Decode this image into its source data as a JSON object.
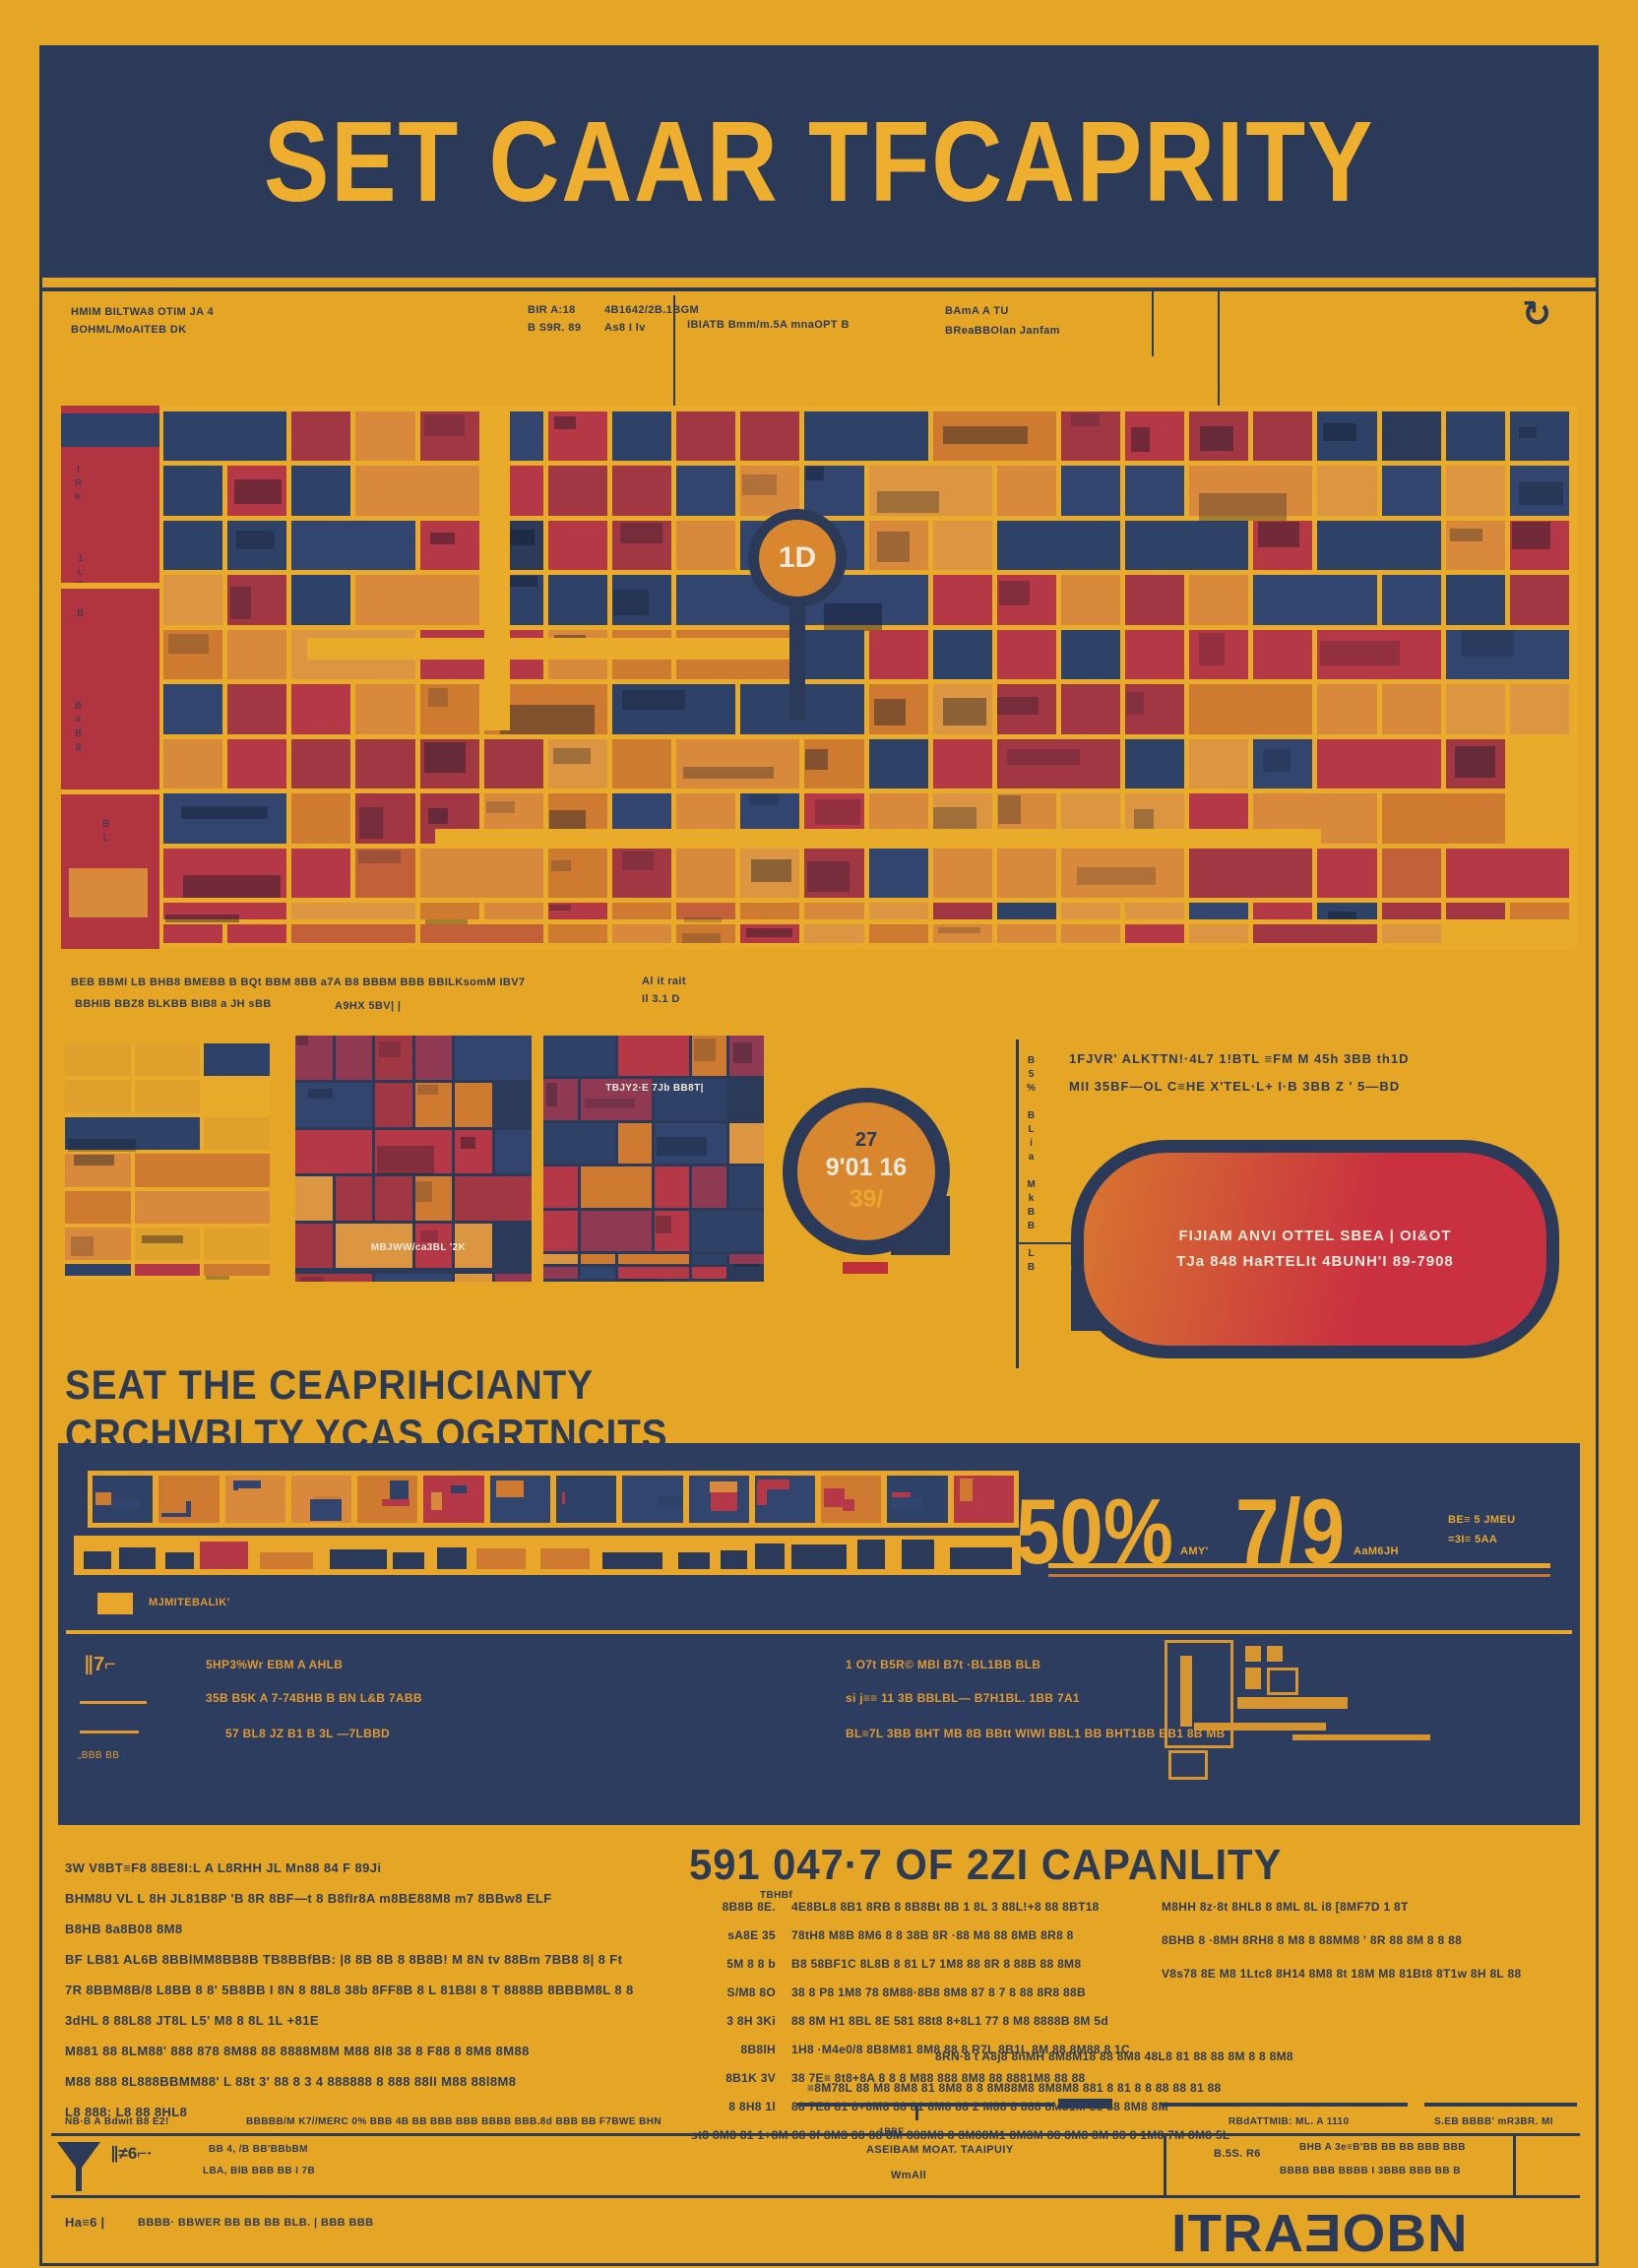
{
  "poster": {
    "title": "SET CAAR TFCAPRITY"
  },
  "colors": {
    "bg": "#E5A525",
    "navy": "#2B3A58",
    "red": "#B43845",
    "orange": "#CE7A31",
    "accent_yellow": "#E9A82B",
    "pill_red": "#C93040"
  },
  "top_annotations": {
    "left_l1": "HMIM BILTWA8 OTIM JA 4",
    "left_l2": "BOHML/MoAITEB DK",
    "m1_l1": "BIR A:18",
    "m1_l2": "B S9R. 89",
    "m2_l1": "4B1642/2B.1BGM",
    "m2_l2": "As8 I lv",
    "m3": "IBIATB Bmm/m.5A mnaOPT B",
    "right_l1": "BAmA A TU",
    "right_l2": "BReaBBOlan Janfam",
    "refresh_icon": "↻"
  },
  "map": {
    "pin_label": "1D",
    "side_m1": "tRK",
    "side_m2": "1L7 B",
    "side_m3": "B≡B8",
    "side_m4": "BL"
  },
  "mid_annotations": {
    "l1": "BEB BBMI LB BHB8 BMEBB B BQt BBM 8BB a7A B8 BBBM BBB BBILKsomM IBV7",
    "l2": "BBHIB BBZ8 BLKBB BIB8 a JH sBB",
    "l2b": "A9HX 5BV| |",
    "r1": "Al it rait",
    "r2": "Il 3.1 D"
  },
  "row2": {
    "panel_b_caption": "MBJWW/ca3BL '2K",
    "panel_c_caption": "TBJY2·E 7Jb BB8T|",
    "bubble_l1": "27",
    "bubble_l2": "9'01 16",
    "bubble_l3": "39/",
    "side_note": "B5% BLia MkBB LB",
    "callout_l1": "1FJVR' ALKTTN!·4L7 1!BTL ≡FM M 45h 3BB th1D",
    "callout_l2": "MII 35BF—OL C≡HE X'TEL·L+ I·B 3BB Z ' 5—BD",
    "pill_l1": "FIJIAM ANVI OTTEL SBEA | OI&OT",
    "pill_l2": "TJa 848 HaRTELIt 4BUNH'I 89-7908"
  },
  "section2": {
    "heading_l1": "SEAT THE CEAPRIHCIANTY",
    "heading_l2": "CRCHVBLTY YCAS QGRTNCITS"
  },
  "stats": {
    "value1": "50%",
    "value1_note": "AMY'",
    "value2": "7/9",
    "value2_note": "AaM6JH",
    "side_l1": "BE≡ 5 JMEU",
    "side_l2": "=3I≡ 5AA",
    "legend": "MJMITEBALIK'",
    "left_marks": "∥7⌐",
    "left_note": "„BBB BB",
    "rows_left_0": "5HP3%Wr EBM A AHLB",
    "rows_left_1": "35B B5K A 7-74BHB B BN L&B 7ABB",
    "rows_left_2": "57 BL8  JZ B1 B 3L —7LBBD",
    "rows_right_0": "1 O7t B5R© MBl B7t ·BL1BB BLB",
    "rows_right_1": "si j≡≡ 11  3B BBLBL— B7H1BL. 1BB 7A1",
    "rows_right_2": "BL≡7L  3BB BHT MB 8B BBtt  WIWl BBL1 BB BHT1BB BB1 8B MB"
  },
  "bottom": {
    "heading": "591 047·7 OF 2ZI CAPANLITY",
    "heading_note": "TBHBf",
    "para_0": "3W V8BT≡F8 8BE8I:L A L8RHH JL Mn88 84 F 89Ji",
    "para_1": "BHM8U VL L 8H JL81B8P 'B 8R 8BF—t 8 B8fIr8A m8BE88M8 m7 8BBw8 ELF",
    "para_2": "B8HB 8a8B08 8M8",
    "para_3": "BF LB81 AL6B 8BBlMM8BB8B TB8BBfBB: |8 8B 8B 8 8B8B! M 8N tv 88Bm 7BB8 8| 8 Ft",
    "para_4": "7R 8BBM8B/8 L8BB 8 8' 5B8BB I 8N 8 88L8 38b 8FF8B 8 L 81B8I 8 T 8888B 8BBBM8L 8 8",
    "para_5": "3dHL  8 88L88 JT8L L5' M8 8 8L 1L +81E",
    "para_6": "M881 88 8LM88' 888 878 8M88 88 8888M8M M88 8l8 38 8 F88 8 8M8 8M88",
    "para_7": "M88  888 8L888BBMM88' L 88t 3' 88 8 3 4 888888 8 888 88lI  M88 88l8M8",
    "para_8": "L8 888: L8 88 8HL8",
    "table_0": {
      "label": "8B8B 8E.",
      "text": "4E8BL8 8B1 8RB 8 8B8Bt 8B 1 8L 3  88L!+8 88 8BT18"
    },
    "table_1": {
      "label": "sA8E 35",
      "text": "78tH8 M8B 8M6 8 8 38B 8R ·88 M8 88 8MB 8R8 8"
    },
    "table_2": {
      "label": "5M 8 8 b",
      "text": "B8 58BF1C 8L8B 8 81 L7 1M8 88  8R 8 88B 88 8M8"
    },
    "table_3": {
      "label": "S/M8 8O",
      "text": "38 8 P8 1M8 78 8M88·8B8 8M8 87 8 7 8  88 8R8 88B"
    },
    "table_4": {
      "label": "3 8H 3Ki",
      "text": "88 8M H1 8BL 8E 581 88t8  8+8L1 77 8 M8  8888B 8M 5d"
    },
    "table_5": {
      "label": "8B8lH",
      "text": "1H8  ·M4e0/8 8B8M81 8M8 88 8  R7L 8B1L 8M 88 8M88 8 1C"
    },
    "table_6": {
      "label": "8B1K 3V",
      "text": "38 7E≡ 8t8+8A 8 8  8 M88 888 8M8 88 8881M8 88 88"
    },
    "table_7": {
      "label": "8 8H8 1l",
      "text": "88 7E8 81 8+8M8 88 81 8M8 88 2 M88 8 888 8M81M 88 88 8M8 8M"
    },
    "table_wide": "st8 8M8 81 1+8M 88 8f 8M8 88 88 8M 888M8 8 8M88M1 8M8M 88 8M8 8M 88 8  1M8 7M 8M8 5L",
    "right_0": "M8HH 8z·8t 8HL8 8 8ML 8L i8 [8MF7D 1 8T",
    "right_1": "8BHB 8  ·8MH 8RH8 8 M8 8 88MM8 ' 8R 88  8M 8 8 88",
    "right_2": "V8s78 8E M8 1Ltc8 8H14 8M8 8t 18M M8 81Bt8 8T1w 8H 8L 88",
    "lower_0": "8RN·8 t A8j8 8nMH 8M8M18 88 8M8 48L8 81 88 88  8M 8 8 8M8",
    "lower_1": "≡8M78L 88 M8 8M8 81 8M8 8 8 8M88M8 8M8M8 881 8 81 8 8  88 88 81 88",
    "note_small": "1BBE"
  },
  "footer": {
    "row_left": "NB·B A Bdwit B8 E2!",
    "row_mid": "BBBBB/M K7//MERC 0% BBB 4B BB BBB BBB BBBB BBB.8d BBB BB F7BWE BHN",
    "row_r1": "RBdATTMIB: ML. A 1110",
    "row_r2": "S.EB BBBB' mR3BR. MI",
    "band_marks": "∥≠6⌐·",
    "band_l1": "BB 4, /B BB'BBbBM",
    "band_l2": "LBA, BlB BBB BB I 7B",
    "band_mid1": "ASEIBAM MOAT. TAAIPUIY",
    "band_mid2": "WmAll",
    "band_label": "B.5S. R6",
    "band_box_l1": "BHB A 3e≡B'BB BB BB BBB BBB",
    "band_box_l2": "BBBB BBB BBBB I 3BBB BBB BB B",
    "final_label": "Ha≡6 |",
    "final_text": "BBBB· BBWER BB BB BB BLB. | BBB BBB",
    "wordmark": "ITRAƎOBN"
  }
}
